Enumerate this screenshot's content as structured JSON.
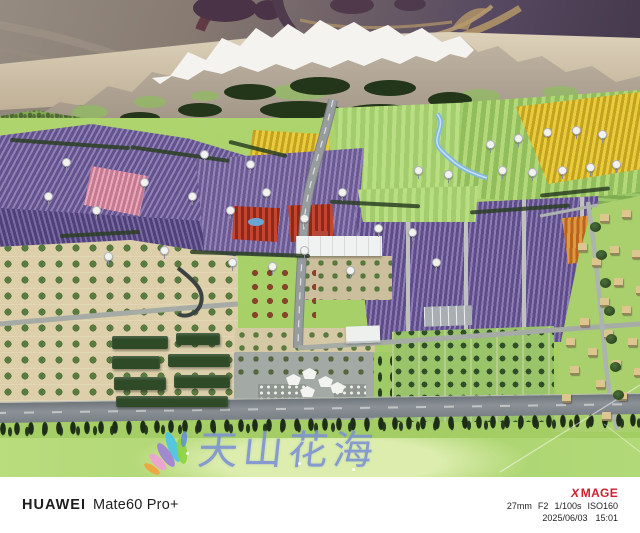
{
  "scene": {
    "sign_title": "天山花海"
  },
  "watermark_bar": {
    "brand": "HUAWEI",
    "model": "Mate60 Pro+",
    "xmage_x": "X",
    "xmage_rest": "MAGE",
    "focal_length": "27mm",
    "aperture": "F2",
    "shutter_speed": "1/100s",
    "iso": "ISO160",
    "date": "2025/06/03",
    "time": "15:01"
  },
  "colors": {
    "xmage_red": "#cf2030",
    "watermark_text": "#1e1e1e",
    "sign_blue": "#7d92d0",
    "lavender_purple": "#63538d",
    "meadow_green": "#a6c973",
    "snow_white": "#f4f3ef",
    "backdrop_purple": "#433749",
    "rim_beige": "#d6c9b2"
  }
}
